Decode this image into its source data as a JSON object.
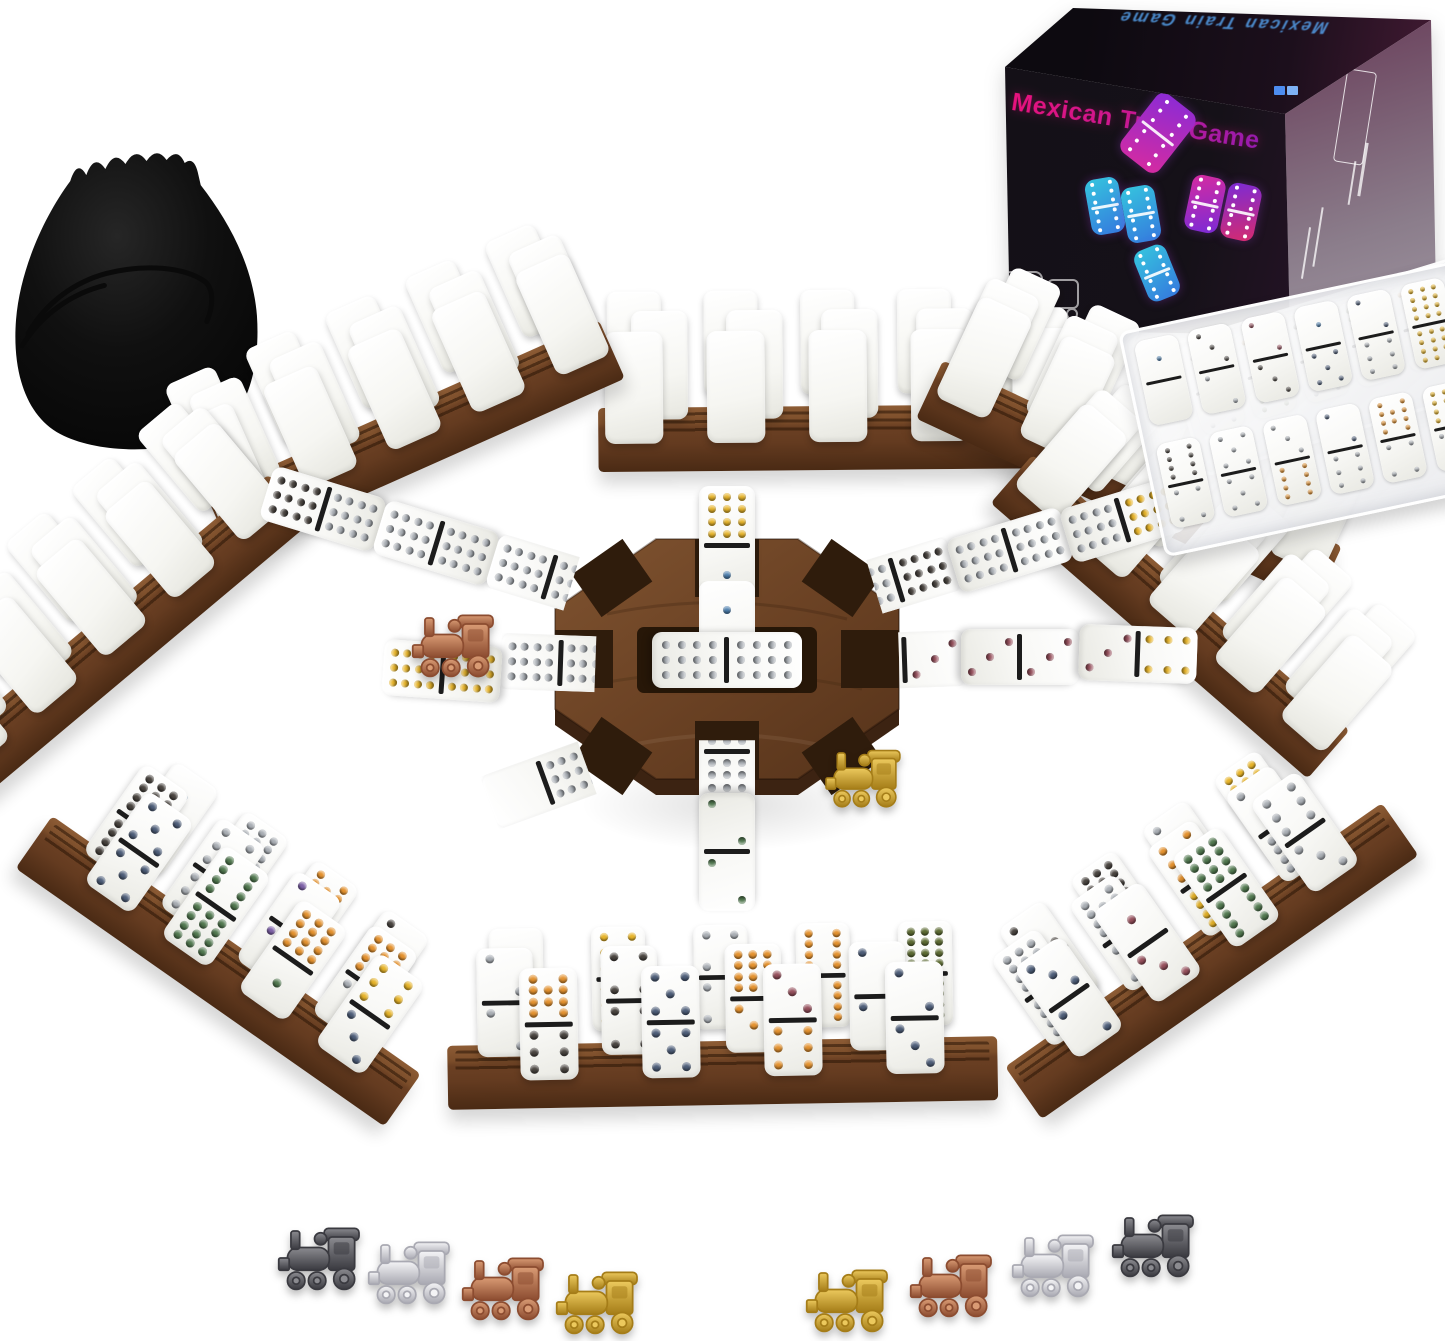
{
  "product": {
    "box_title": "Mexican Train Game",
    "box_top_text": "Mexican Train Game"
  },
  "palette": {
    "yellow": "#e7b42a",
    "orange": "#e4922f",
    "gray": "#a9aeb4",
    "black": "#4a4540",
    "blue": "#4d7fae",
    "navy": "#4e5e79",
    "maroon": "#96505c",
    "green": "#527950",
    "dkgreen": "#5d6b33",
    "purple": "#7e62a8",
    "white": "#f5f5f5"
  },
  "metals": {
    "gunmetal": [
      "#8b8b90",
      "#3a3a40"
    ],
    "silver": [
      "#f4f4f6",
      "#a9a9b2"
    ],
    "copper": [
      "#d99b74",
      "#8c4c30"
    ],
    "gold": [
      "#ecc95d",
      "#a57d18"
    ]
  },
  "hub": {
    "x": 727,
    "y": 667,
    "center_domino": {
      "a": 12,
      "b": 12,
      "ca": "gray",
      "cb": "gray"
    }
  },
  "chains": [
    {
      "name": "chain-top-outer",
      "x": 727,
      "y": 545,
      "rot": 0,
      "a": 12,
      "b": 1,
      "ca": "yellow",
      "cb": "blue",
      "clip": 0
    },
    {
      "name": "chain-top-inner",
      "x": 727,
      "y": 640,
      "rot": 0,
      "a": 1,
      "b": 12,
      "ca": "blue",
      "cb": "gray",
      "clip": 25
    },
    {
      "name": "chain-upleft-tip",
      "x": 323,
      "y": 509,
      "rot": -73,
      "a": 12,
      "b": 12,
      "ca": "black",
      "cb": "gray",
      "clip": 0
    },
    {
      "name": "chain-upleft-mid",
      "x": 436,
      "y": 543,
      "rot": -73,
      "a": 12,
      "b": 12,
      "ca": "gray",
      "cb": "gray",
      "clip": 0
    },
    {
      "name": "chain-upleft-inner",
      "x": 549,
      "y": 577,
      "rot": -73,
      "a": 12,
      "b": 12,
      "ca": "gray",
      "cb": "gray",
      "clip": 30
    },
    {
      "name": "chain-upright-inner",
      "x": 897,
      "y": 580,
      "rot": 73,
      "a": 12,
      "b": 12,
      "ca": "black",
      "cb": "gray",
      "clip": 30
    },
    {
      "name": "chain-upright-mid",
      "x": 1010,
      "y": 550,
      "rot": 73,
      "a": 12,
      "b": 12,
      "ca": "gray",
      "cb": "gray",
      "clip": 0
    },
    {
      "name": "chain-upright-tip",
      "x": 1123,
      "y": 520,
      "rot": 73,
      "a": 12,
      "b": 12,
      "ca": "yellow",
      "cb": "gray",
      "clip": 0
    },
    {
      "name": "chain-left-inner",
      "x": 560,
      "y": 663,
      "rot": -88,
      "a": 12,
      "b": 12,
      "ca": "gray",
      "cb": "gray",
      "clip": 20
    },
    {
      "name": "chain-left-outer",
      "x": 442,
      "y": 671,
      "rot": -86,
      "a": 12,
      "b": 12,
      "ca": "yellow",
      "cb": "yellow",
      "clip": 0
    },
    {
      "name": "chain-right-inner",
      "x": 905,
      "y": 660,
      "rot": 88,
      "a": 3,
      "b": 12,
      "ca": "maroon",
      "cb": "gray",
      "clip": 45
    },
    {
      "name": "chain-right-mid",
      "x": 1020,
      "y": 657,
      "rot": 90,
      "a": 3,
      "b": 3,
      "ca": "maroon",
      "cb": "maroon",
      "clip": 0
    },
    {
      "name": "chain-right-tip",
      "x": 1138,
      "y": 654,
      "rot": 92,
      "a": 6,
      "b": 3,
      "ca": "yellow",
      "cb": "maroon",
      "clip": 0
    },
    {
      "name": "chain-bottom-inner",
      "x": 727,
      "y": 752,
      "rot": 180,
      "a": 12,
      "b": 12,
      "ca": "gray",
      "cb": "gray",
      "clip": 40
    },
    {
      "name": "chain-bottom-outer",
      "x": 727,
      "y": 852,
      "rot": 180,
      "a": 2,
      "b": 2,
      "ca": "green",
      "cb": "green",
      "clip": 0
    },
    {
      "name": "chain-lowleft",
      "x": 545,
      "y": 783,
      "rot": 250,
      "a": 0,
      "b": 12,
      "ca": "gray",
      "cb": "gray",
      "clip": 12
    }
  ],
  "racks": [
    {
      "name": "rack-top",
      "x": 838,
      "y": 400,
      "rot": -0.5,
      "len": 480,
      "z": 4,
      "rows": [
        {
          "n": 5,
          "gap": 46,
          "shift": -10
        },
        {
          "n": 5,
          "gap": 40,
          "shift": 12
        },
        {
          "n": 5,
          "gap": 44,
          "shift": 0
        }
      ]
    },
    {
      "name": "rack-upper-left",
      "x": 400,
      "y": 402,
      "rot": -24,
      "len": 430,
      "z": 4,
      "rows": [
        {
          "n": 5,
          "gap": 36,
          "shift": -8
        },
        {
          "n": 5,
          "gap": 32,
          "shift": 10
        },
        {
          "n": 5,
          "gap": 34,
          "shift": 0
        }
      ]
    },
    {
      "name": "rack-left",
      "x": 100,
      "y": 608,
      "rot": -40,
      "len": 430,
      "z": 4,
      "rows": [
        {
          "n": 5,
          "gap": 34,
          "shift": -6
        },
        {
          "n": 5,
          "gap": 30,
          "shift": 10
        },
        {
          "n": 5,
          "gap": 32,
          "shift": 0
        }
      ]
    },
    {
      "name": "rack-upper-right",
      "x": 1145,
      "y": 448,
      "rot": 25,
      "len": 440,
      "z": 4,
      "rows": [
        {
          "n": 5,
          "gap": 36,
          "shift": 6
        },
        {
          "n": 5,
          "gap": 32,
          "shift": -10
        },
        {
          "n": 5,
          "gap": 34,
          "shift": 0
        }
      ]
    },
    {
      "name": "rack-right",
      "x": 1195,
      "y": 588,
      "rot": 41,
      "len": 420,
      "z": 4,
      "rows": [
        {
          "n": 5,
          "gap": 32,
          "shift": 6
        },
        {
          "n": 5,
          "gap": 28,
          "shift": -8
        },
        {
          "n": 5,
          "gap": 30,
          "shift": 0
        }
      ]
    },
    {
      "name": "rack-bottom-left",
      "x": 240,
      "y": 940,
      "rot": 35,
      "len": 450,
      "z": 7,
      "rows": [
        {
          "gap": 34,
          "shift": 0,
          "d": [
            [
              1,
              6,
              "blue",
              "orange"
            ],
            [
              12,
              12,
              "gray",
              "gray"
            ],
            [
              10,
              10,
              "orange",
              "orange"
            ],
            [
              2,
              2,
              "black",
              "black"
            ]
          ]
        },
        {
          "gap": 38,
          "shift": -12,
          "d": [
            [
              12,
              12,
              "black",
              "black"
            ],
            [
              6,
              6,
              "gray",
              "gray"
            ],
            [
              3,
              3,
              "purple",
              "purple"
            ],
            [
              12,
              2,
              "orange",
              "gray"
            ]
          ]
        },
        {
          "gap": 36,
          "shift": 8,
          "d": [
            [
              5,
              5,
              "navy",
              "navy"
            ],
            [
              8,
              12,
              "green",
              "green"
            ],
            [
              12,
              1,
              "orange",
              "green"
            ],
            [
              6,
              3,
              "yellow",
              "navy"
            ]
          ]
        }
      ]
    },
    {
      "name": "rack-bottom-center",
      "x": 722,
      "y": 1035,
      "rot": -1,
      "len": 550,
      "z": 7,
      "rows": [
        {
          "gap": 52,
          "shift": 0,
          "d": [
            [],
            [
              6,
              6,
              "yellow",
              "yellow"
            ],
            [
              4,
              4,
              "gray",
              "gray"
            ],
            [
              8,
              8,
              "orange",
              "orange"
            ],
            [
              12,
              12,
              "dkgreen",
              "dkgreen"
            ]
          ]
        },
        {
          "gap": 70,
          "shift": -30,
          "d": [
            [
              2,
              2,
              "gray",
              "gray"
            ],
            [
              4,
              4,
              "black",
              "black"
            ],
            [
              12,
              3,
              "orange",
              "orange"
            ],
            [
              2,
              2,
              "navy",
              "navy"
            ]
          ]
        },
        {
          "gap": 64,
          "shift": 10,
          "d": [
            [
              10,
              6,
              "orange",
              "black"
            ],
            [
              5,
              5,
              "navy",
              "navy"
            ],
            [
              3,
              6,
              "maroon",
              "orange"
            ],
            [
              2,
              3,
              "navy",
              "navy"
            ]
          ]
        }
      ]
    },
    {
      "name": "rack-bottom-right",
      "x": 1190,
      "y": 930,
      "rot": -35,
      "len": 460,
      "z": 7,
      "rows": [
        {
          "gap": 36,
          "shift": 0,
          "d": [
            [
              2,
              2,
              "black",
              "black"
            ],
            [
              12,
              12,
              "black",
              "black"
            ],
            [
              3,
              6,
              "gray",
              "orange"
            ],
            [
              12,
              6,
              "yellow",
              "yellow"
            ]
          ]
        },
        {
          "gap": 40,
          "shift": -10,
          "d": [
            [
              12,
              12,
              "gray",
              "gray"
            ],
            [
              10,
              5,
              "gray",
              "gray"
            ],
            [
              6,
              12,
              "orange",
              "yellow"
            ],
            [
              3,
              12,
              "gray",
              "gray"
            ]
          ]
        },
        {
          "gap": 38,
          "shift": 6,
          "d": [
            [
              3,
              2,
              "navy",
              "navy"
            ],
            [
              1,
              3,
              "maroon",
              "maroon"
            ],
            [
              12,
              8,
              "green",
              "green"
            ],
            [
              6,
              3,
              "gray",
              "gray"
            ]
          ]
        }
      ]
    }
  ],
  "trays": [
    {
      "name": "domino-case-back",
      "x": 1336,
      "y": 348,
      "rot": -17,
      "z": 5,
      "rows": [
        [
          [
            2,
            5,
            "black",
            "gray"
          ],
          [
            3,
            8,
            "orange",
            "dkgreen"
          ],
          [
            5,
            4,
            "black",
            "gray"
          ],
          [
            8,
            2,
            "dkgreen",
            "orange"
          ],
          [
            2,
            6,
            "orange",
            "gray"
          ],
          [
            6,
            3,
            "dkgreen",
            "black"
          ]
        ]
      ]
    },
    {
      "name": "domino-case-front",
      "x": 1298,
      "y": 396,
      "rot": -12,
      "z": 6,
      "rows": [
        [
          [
            1,
            0,
            "blue",
            "gray"
          ],
          [
            3,
            2,
            "black",
            "gray"
          ],
          [
            2,
            3,
            "maroon",
            "black"
          ],
          [
            1,
            5,
            "blue",
            "navy"
          ],
          [
            2,
            6,
            "navy",
            "gray"
          ],
          [
            12,
            12,
            "yellow",
            "yellow"
          ]
        ],
        [
          [
            8,
            4,
            "black",
            "gray"
          ],
          [
            5,
            5,
            "gray",
            "gray"
          ],
          [
            3,
            8,
            "gray",
            "orange"
          ],
          [
            2,
            6,
            "navy",
            "gray"
          ],
          [
            10,
            4,
            "orange",
            "gray"
          ],
          [
            12,
            2,
            "yellow",
            "gray"
          ]
        ]
      ]
    }
  ],
  "scene_trains": [
    {
      "name": "train-marker-copper-on-chain",
      "x": 452,
      "y": 645,
      "metal": "copper",
      "s": 1.0
    },
    {
      "name": "train-marker-gold-on-hub",
      "x": 862,
      "y": 778,
      "metal": "gold",
      "s": 0.92
    }
  ],
  "markers": [
    {
      "name": "train-marker-gunmetal-left",
      "x": 318,
      "y": 1258,
      "metal": "gunmetal"
    },
    {
      "name": "train-marker-silver-left",
      "x": 408,
      "y": 1272,
      "metal": "silver"
    },
    {
      "name": "train-marker-copper-left",
      "x": 502,
      "y": 1288,
      "metal": "copper"
    },
    {
      "name": "train-marker-gold-left",
      "x": 596,
      "y": 1302,
      "metal": "gold"
    },
    {
      "name": "train-marker-gold-right",
      "x": 846,
      "y": 1300,
      "metal": "gold"
    },
    {
      "name": "train-marker-copper-right",
      "x": 950,
      "y": 1285,
      "metal": "copper"
    },
    {
      "name": "train-marker-silver-right",
      "x": 1052,
      "y": 1265,
      "metal": "silver"
    },
    {
      "name": "train-marker-gunmetal-right",
      "x": 1152,
      "y": 1245,
      "metal": "gunmetal"
    }
  ],
  "box": {
    "graphics": [
      {
        "x": 146,
        "y": 96,
        "w": 48,
        "h": 74,
        "rot": 38,
        "c1": "#8a2bd6",
        "c2": "#d62ba0"
      },
      {
        "x": 100,
        "y": 178,
        "w": 34,
        "h": 56,
        "rot": -10,
        "c1": "#35c4de",
        "c2": "#3579de"
      },
      {
        "x": 136,
        "y": 186,
        "w": 34,
        "h": 56,
        "rot": -10,
        "c1": "#35c4de",
        "c2": "#3579de"
      },
      {
        "x": 200,
        "y": 176,
        "w": 34,
        "h": 56,
        "rot": 12,
        "c1": "#d62ba0",
        "c2": "#7b2bd6"
      },
      {
        "x": 236,
        "y": 184,
        "w": 34,
        "h": 56,
        "rot": 12,
        "c1": "#7b2bd6",
        "c2": "#d62b6e"
      },
      {
        "x": 152,
        "y": 246,
        "w": 34,
        "h": 54,
        "rot": -22,
        "c1": "#35c4de",
        "c2": "#3579de"
      }
    ]
  }
}
